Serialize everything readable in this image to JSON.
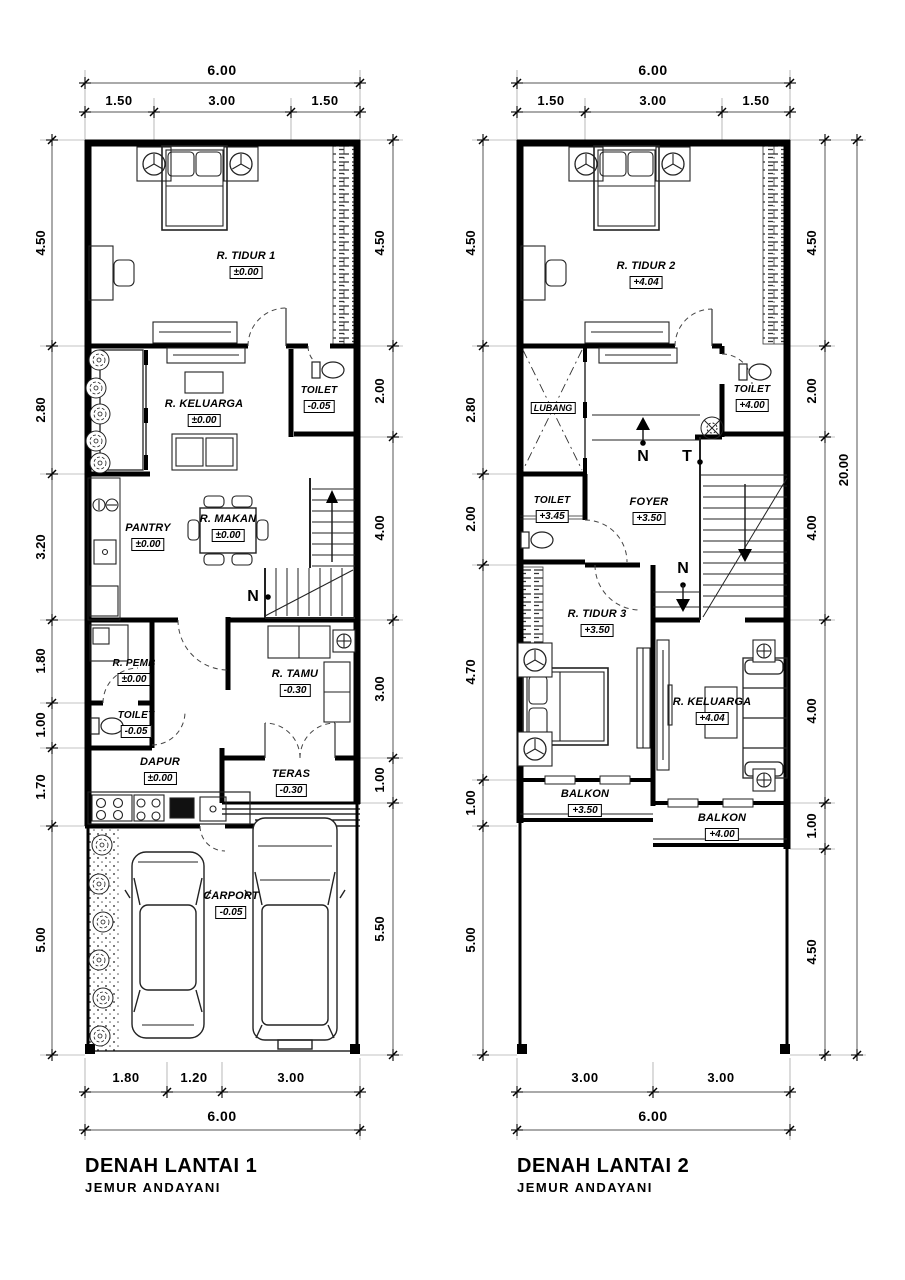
{
  "plan1": {
    "title": "DENAH LANTAI 1",
    "subtitle": "JEMUR  ANDAYANI",
    "marker_n": "N",
    "dims": {
      "top_total": "6.00",
      "top_segments": [
        "1.50",
        "3.00",
        "1.50"
      ],
      "left_segments": [
        "4.50",
        "2.80",
        "3.20",
        "1.80",
        "1.00",
        "1.70",
        "5.00"
      ],
      "right_segments": [
        "4.50",
        "2.00",
        "4.00",
        "3.00",
        "1.00",
        "5.50"
      ],
      "bottom_segments": [
        "1.80",
        "1.20",
        "3.00"
      ],
      "bottom_total": "6.00"
    },
    "rooms": {
      "tidur1": {
        "name": "R. TIDUR 1",
        "elev": "±0.00"
      },
      "keluarga": {
        "name": "R. KELUARGA",
        "elev": "±0.00"
      },
      "toilet_atas": {
        "name": "TOILET",
        "elev": "-0.05"
      },
      "pantry": {
        "name": "PANTRY",
        "elev": "±0.00"
      },
      "makan": {
        "name": "R. MAKAN",
        "elev": "±0.00"
      },
      "pemb": {
        "name": "R. PEMB",
        "elev": "±0.00"
      },
      "toilet_bawah": {
        "name": "TOILET",
        "elev": "-0.05"
      },
      "dapur": {
        "name": "DAPUR",
        "elev": "±0.00"
      },
      "tamu": {
        "name": "R. TAMU",
        "elev": "-0.30"
      },
      "teras": {
        "name": "TERAS",
        "elev": "-0.30"
      },
      "carport": {
        "name": "CARPORT",
        "elev": "-0.05"
      }
    }
  },
  "plan2": {
    "title": "DENAH LANTAI 2",
    "subtitle": "JEMUR  ANDAYANI",
    "marker_n_top": "N",
    "marker_t": "T",
    "marker_n_bottom": "N",
    "dims": {
      "top_total": "6.00",
      "top_segments": [
        "1.50",
        "3.00",
        "1.50"
      ],
      "left_segments": [
        "4.50",
        "2.80",
        "2.00",
        "4.70",
        "1.00",
        "5.00"
      ],
      "right_segments": [
        "4.50",
        "2.00",
        "4.00",
        "4.00",
        "1.00",
        "4.50"
      ],
      "right_total": "20.00",
      "bottom_segments": [
        "3.00",
        "3.00"
      ],
      "bottom_total": "6.00"
    },
    "rooms": {
      "tidur2": {
        "name": "R. TIDUR 2",
        "elev": "+4.04"
      },
      "toilet_atas": {
        "name": "TOILET",
        "elev": "+4.00"
      },
      "lubang": {
        "name": "LUBANG"
      },
      "foyer": {
        "name": "FOYER",
        "elev": "+3.50"
      },
      "toilet_kiri": {
        "name": "TOILET",
        "elev": "+3.45"
      },
      "tidur3": {
        "name": "R. TIDUR 3",
        "elev": "+3.50"
      },
      "keluarga": {
        "name": "R. KELUARGA",
        "elev": "+4.04"
      },
      "balkon_kiri": {
        "name": "BALKON",
        "elev": "+3.50"
      },
      "balkon_kanan": {
        "name": "BALKON",
        "elev": "+4.00"
      }
    }
  }
}
